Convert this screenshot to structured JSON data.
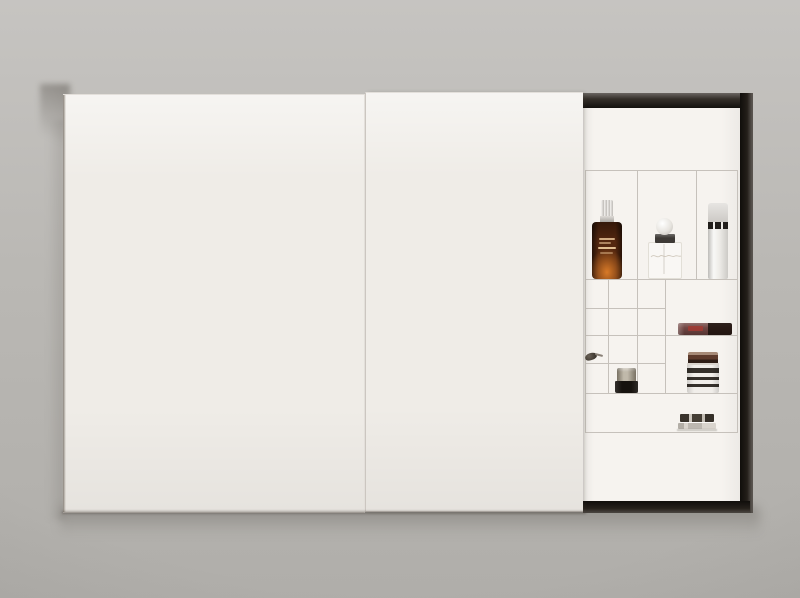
{
  "scene": {
    "subject": "wall-mounted beauty advent-calendar box, two white sliding doors, right section open showing product compartments",
    "wall_color": "#bab8b4",
    "door_color": "#efece7",
    "frame_color": "#2a241e",
    "interior_color": "#f6f3ef",
    "grid_line_color": "#c6c1bb"
  },
  "products": {
    "serum": {
      "name": "amber-dropper-serum-bottle",
      "body_color": "#54270f",
      "glow_color": "#d87a28",
      "cap_color": "#dcdad6"
    },
    "perfume": {
      "name": "perfume-bottle-ball-cap",
      "ball_color": "#e7e4df",
      "collar_color": "#3e3a36"
    },
    "pump": {
      "name": "white-cylinder-pump-bottle",
      "body_color": "#edebe7",
      "band_color": "#211e1b"
    },
    "gloss": {
      "name": "lip-gloss-tube",
      "body_color": "#714643",
      "cap_color": "#2c211a",
      "label_color": "#a23a32"
    },
    "brush": {
      "name": "mini-applicator-brush-tip",
      "color": "#3e3830"
    },
    "mini_jar": {
      "name": "mini-jar-black-base",
      "cap_color": "#a89e8a",
      "body_color": "#16120e"
    },
    "striped_jar": {
      "name": "striped-label-jar",
      "lid_color": "#5d3b2c",
      "body_color": "#f1eeea",
      "stripe_color": "#35302b"
    },
    "tin": {
      "name": "flat-round-tin",
      "color": "#8a847c"
    }
  }
}
